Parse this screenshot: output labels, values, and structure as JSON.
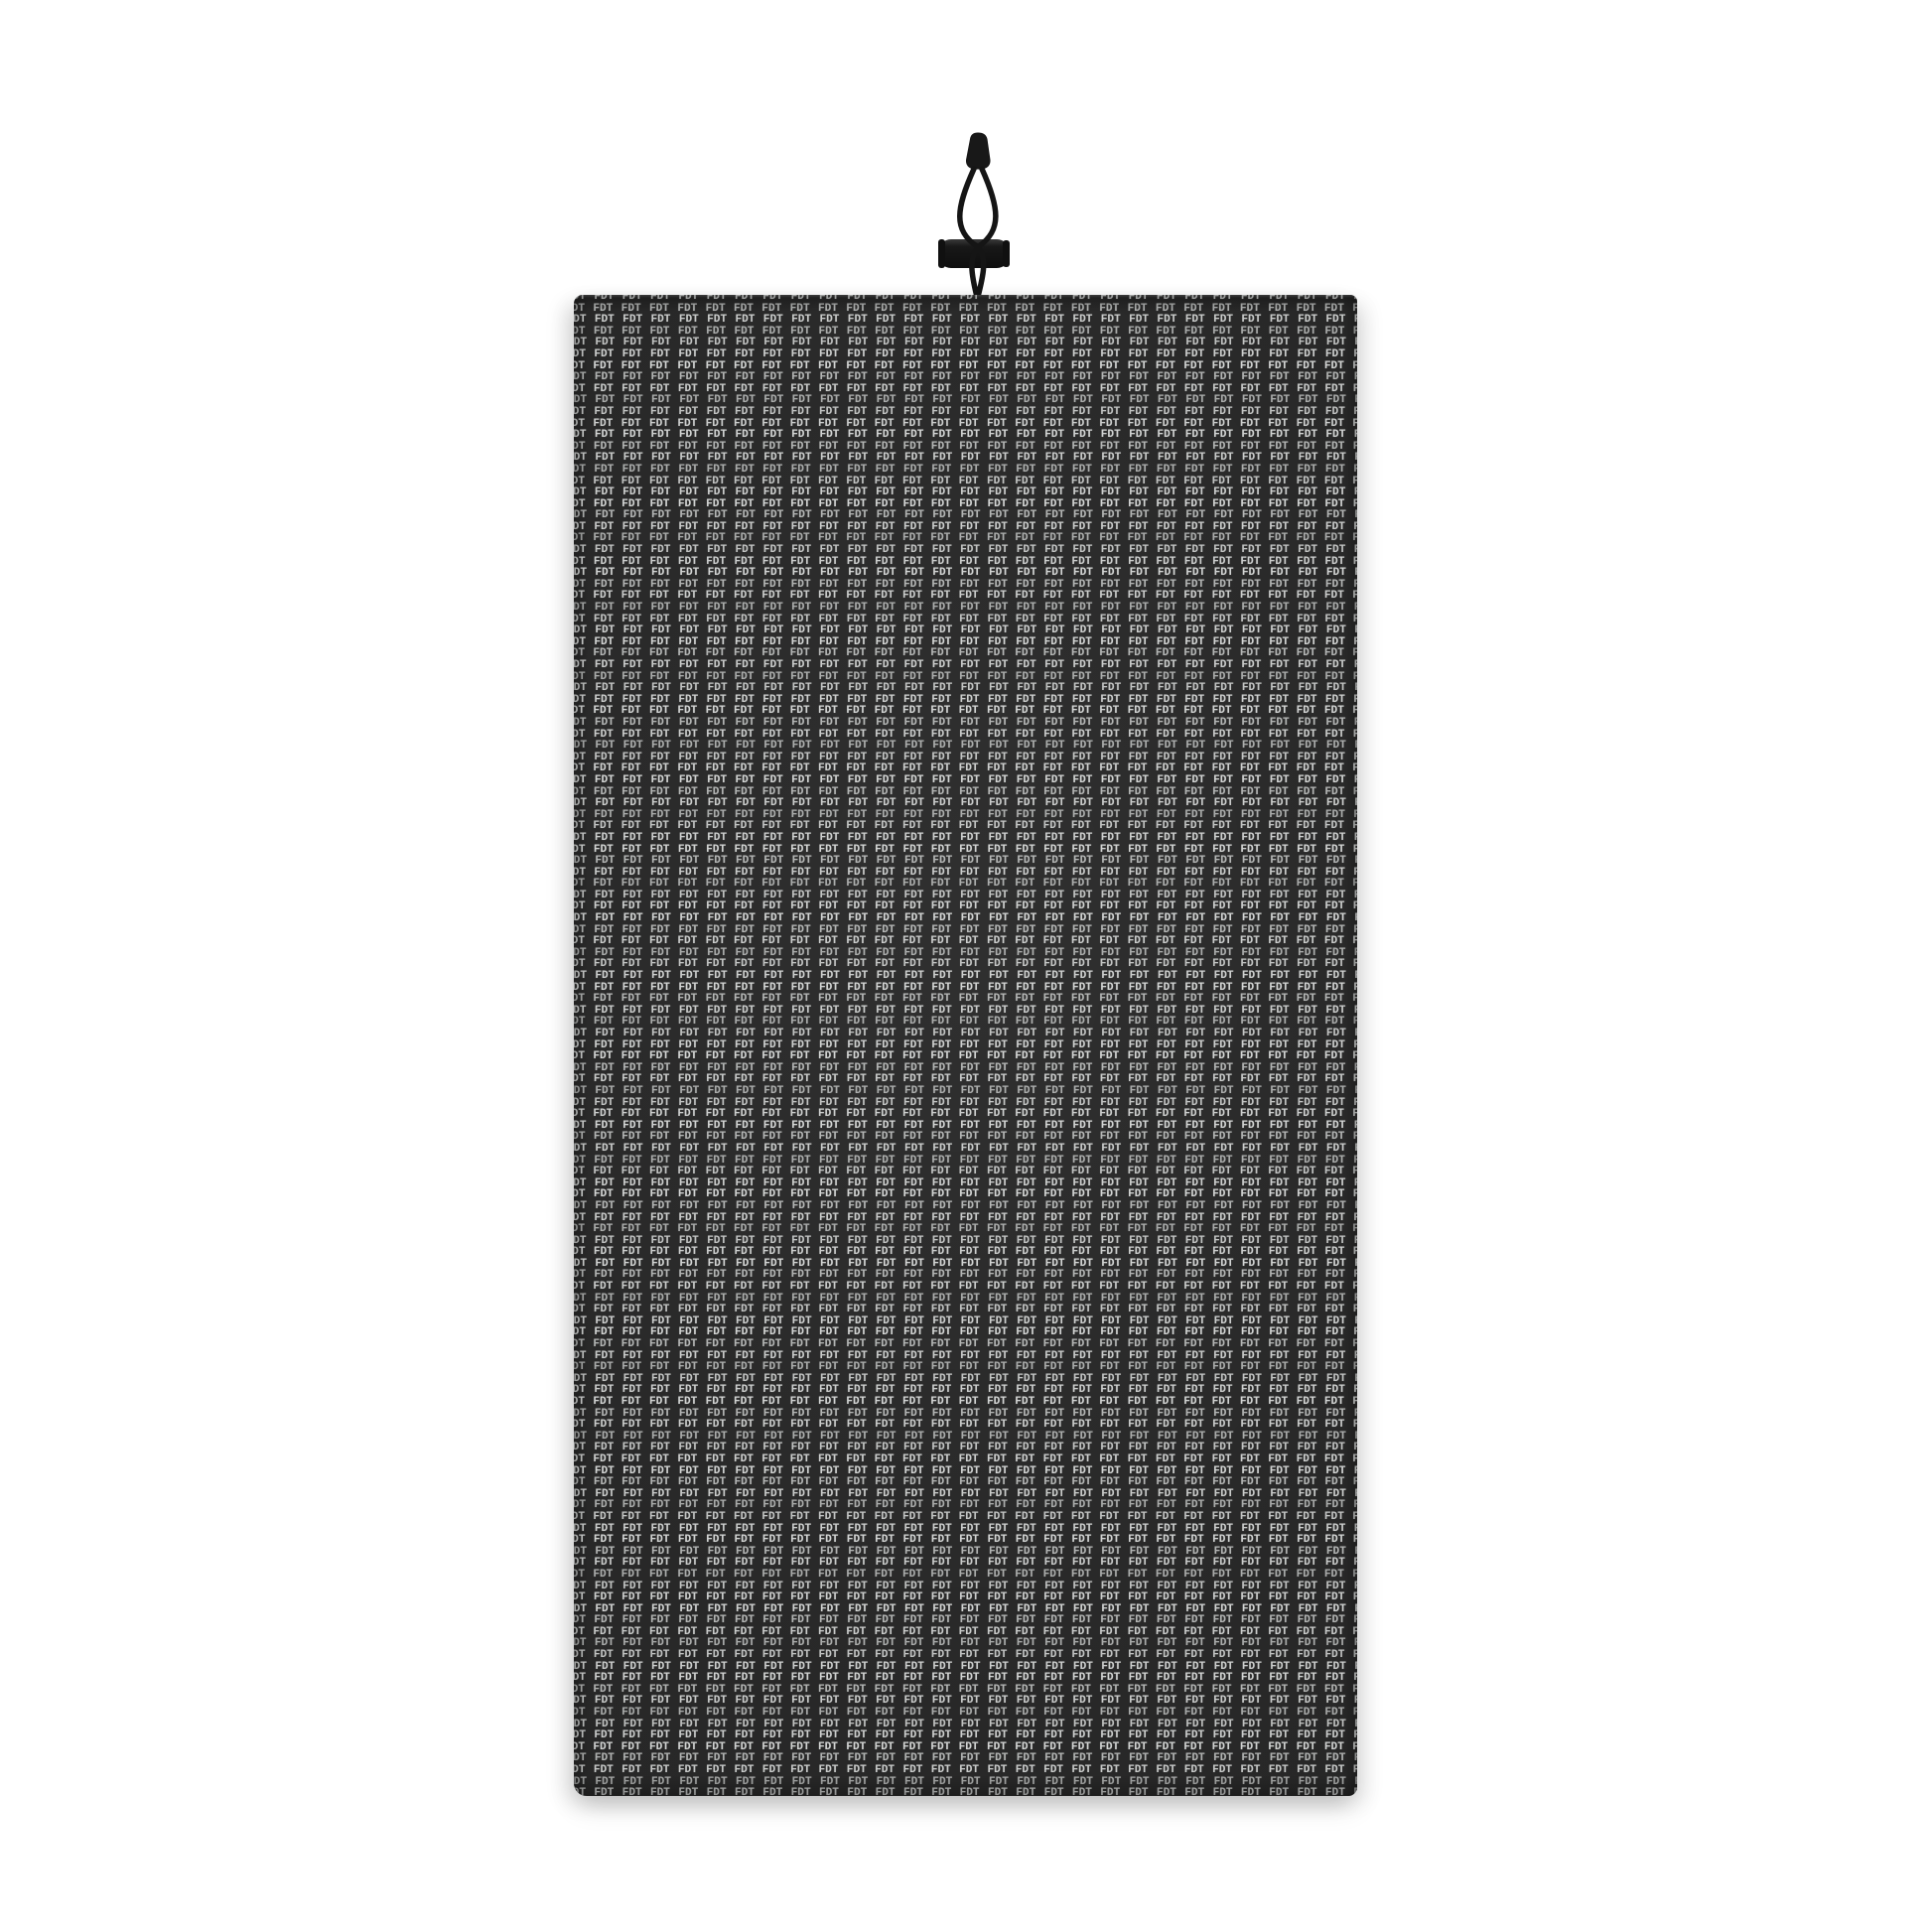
{
  "page": {
    "background_color": "#ffffff"
  },
  "product": {
    "pattern": {
      "text": "FDT",
      "text_color": "#c6c8c7",
      "fabric_color": "#282828"
    },
    "drawstring": {
      "cord_color": "#151515",
      "toggle_color": "#1a1a1a"
    }
  }
}
